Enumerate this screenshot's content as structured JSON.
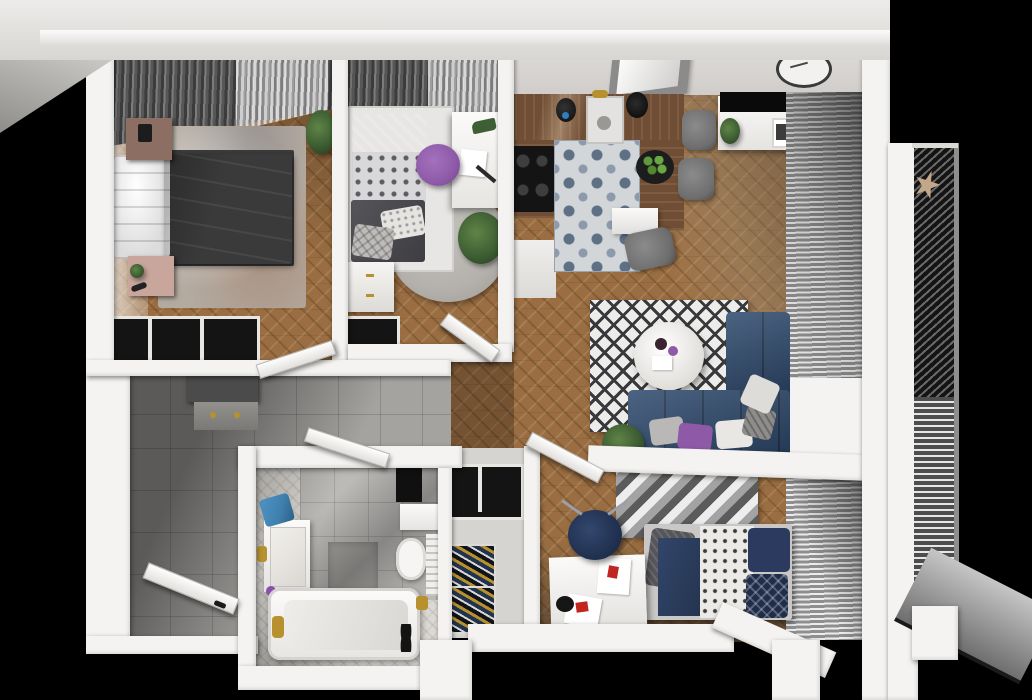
{
  "meta": {
    "description": "3D top-down rendered floor plan of a two/three-bedroom apartment, no visible text labels",
    "view": "bird's-eye 3D render",
    "canvas": {
      "width": 1032,
      "height": 700
    }
  },
  "palette": {
    "bg": "#000000",
    "wall": "#f4f3f1",
    "wallShadow": "#d8d6d3",
    "topBandLight": "#eceae8",
    "topBandDark": "#d6d4d1",
    "innerWallFace": "#dddbd8",
    "wood": "#9a6e42",
    "woodDark": "#7c5733",
    "tileGray": "#a5a3a0",
    "bathFloor": "#dcd9d4",
    "bathTile": "#bcbab7",
    "kitchenTileBg": "#d3d6d8",
    "kitchenTileInk": "#5e7085",
    "kitchenTileInk2": "#8d9aab",
    "counterWood": "#6f4e35",
    "cooktop": "#141414",
    "curtainDark": "#3c3c3c",
    "curtainLight": "#7c7c7c",
    "sheer": "#e3e3e3",
    "blindLight": "#ececec",
    "blindDark": "#8f8f8f",
    "balconyDark": "#161616",
    "balconySlat": "#6a6a6a",
    "purple": "#6d4591",
    "purpleDark": "#57356f",
    "navy": "#2e4a6e",
    "navyDark": "#1f3050",
    "plum": "#8e5aa8",
    "rugBeige": "#b3aaa0",
    "rugGray": "#b4b1ad",
    "chairGray": "#6e6e6e",
    "plant": "#3e5f33",
    "plantDark": "#2c4424",
    "gold": "#b8912f",
    "nightstand1": "#8d6e63",
    "nightstand2": "#c9a69c",
    "white": "#ffffff",
    "offWhite": "#eceae7",
    "black": "#0a0a0a",
    "towelBlue": "#3f7fae",
    "bedFrameGray": "#c9c8c6",
    "darkGray": "#4b4b4b"
  },
  "scene": {
    "rooms": [
      {
        "name": "master-bedroom",
        "floor": "wood-chevron",
        "furniture": [
          "double-bed-purple-duvet",
          "white-gray-pillow-stack",
          "nightstand-upper",
          "nightstand-lower",
          "beige-area-rug",
          "dark-curtains",
          "open-wardrobe-with-clothes",
          "potted-plant"
        ]
      },
      {
        "name": "second-bedroom",
        "floor": "wood-chevron",
        "furniture": [
          "single-bed-purple-pillows",
          "patterned-duvet",
          "white-desk",
          "plum-desk-chair",
          "round-gray-rug",
          "floor-plant",
          "white-dresser",
          "clothes-rack"
        ]
      },
      {
        "name": "kitchen-dining",
        "floor": "wood-chevron-and-patterned-tile",
        "furniture": [
          "walnut-counter-l-shape",
          "induction-cooktop",
          "sink-gold-faucet",
          "black-kettle",
          "black-vase",
          "fruit-tray-green-apples",
          "gray-dining-chairs",
          "white-dining-table",
          "tv-sideboard",
          "wall-clock",
          "skylight-window"
        ]
      },
      {
        "name": "living-area",
        "floor": "wood-chevron",
        "furniture": [
          "navy-corner-sofa",
          "throw-pillows",
          "round-white-coffee-table",
          "diamond-pattern-rug",
          "floor-plant",
          "venetian-blind-windows",
          "half-wall-ledge"
        ]
      },
      {
        "name": "third-bedroom",
        "floor": "wood-chevron",
        "furniture": [
          "single-bed-navy-bedding",
          "white-desk-with-posters",
          "navy-desk-chair",
          "chevron-gray-rug",
          "venetian-blind-window"
        ]
      },
      {
        "name": "bathroom",
        "floor": "light-herringbone-tile",
        "furniture": [
          "bathtub-gold-tap",
          "marble-vanity-sink",
          "toilet",
          "black-wall-shelf",
          "towel-radiator",
          "blue-towel",
          "gold-bin",
          "black-slippers"
        ]
      },
      {
        "name": "hallway",
        "floor": "gray-stone-tile",
        "furniture": [
          "gray-shoe-cabinet",
          "open-entry-door"
        ]
      },
      {
        "name": "closet-nook",
        "floor": "light-tile",
        "furniture": [
          "hanging-rack",
          "shoe-shelves"
        ]
      },
      {
        "name": "balcony",
        "floor": "dark-slatted-decking",
        "furniture": [
          "star-ornament"
        ]
      }
    ],
    "open_doors": [
      "master-bedroom-door",
      "second-bedroom-door",
      "bathroom-door",
      "third-bedroom-door",
      "entry-door"
    ]
  }
}
